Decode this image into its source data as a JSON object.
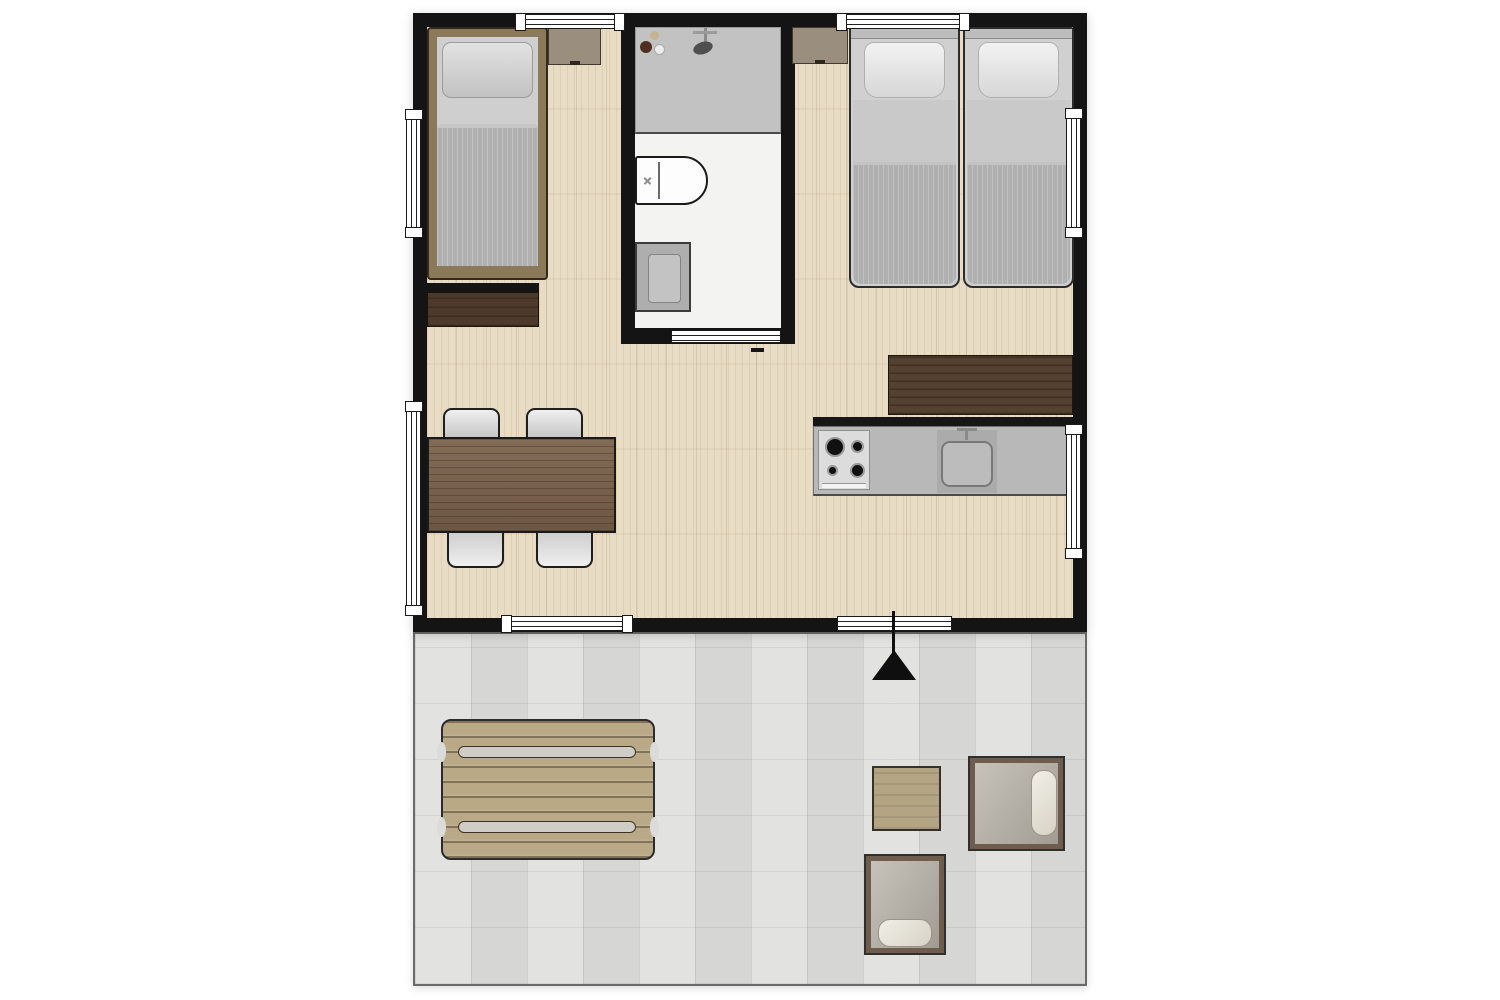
{
  "meta": {
    "type": "floor-plan",
    "view": "top-down",
    "visible_text": "none"
  },
  "palette": {
    "page_bg": "#ffffff",
    "wall": "#141414",
    "wood_floor": "#e9dcc4",
    "bathroom_floor": "#f3f3f1",
    "terrace_floor": "#dbdbd9",
    "window_white": "#ffffff",
    "shower_gray": "#c2c2c2",
    "fixture_white": "#fdfdfd",
    "counter_gray": "#b8b8b8",
    "stove_gray": "#dcdcdc",
    "cabinet_brown": "#54412f",
    "table_brown": "#79614a",
    "bed_frame_tan": "#8c795a",
    "mattress_gray": "#cfcfcf",
    "blanket_gray": "#b0b0b0",
    "pillow_light": "#efefef",
    "nightstand_tan": "#9a8e7e",
    "dresser_brown": "#4d3a2a",
    "chair_gray": "#d8d8d8",
    "picnic_wood": "#b9a987",
    "side_table_wood": "#b3a483",
    "armchair_frame": "#6e5c4d",
    "armchair_seat": "#b5b0a7",
    "cushion_cream": "#ece8dd",
    "arrow_black": "#0f0f0f"
  },
  "plan": {
    "building": {
      "rooms": [
        {
          "name": "bedroom-single",
          "furniture": [
            "single-bed",
            "nightstand",
            "dresser"
          ]
        },
        {
          "name": "bathroom",
          "furniture": [
            "shower",
            "toilet",
            "washbasin"
          ],
          "door": "sliding-door-bottom"
        },
        {
          "name": "bedroom-twin",
          "furniture": [
            "twin-bed-left",
            "twin-bed-right",
            "nightstand"
          ]
        },
        {
          "name": "living-dining",
          "furniture": [
            "dining-table",
            "chair",
            "chair",
            "chair",
            "chair"
          ]
        },
        {
          "name": "kitchenette",
          "furniture": [
            "tall-cabinet",
            "counter",
            "hob-4-burner",
            "kitchen-sink"
          ]
        }
      ],
      "windows": {
        "top_wall": 2,
        "left_wall": 2,
        "right_wall": 2,
        "bottom_wall": 1
      },
      "entrance": "bottom-wall-door-with-up-arrow"
    },
    "terrace": {
      "floor": "tiled",
      "furniture": [
        "picnic-table",
        "side-table",
        "lounge-armchair-facing-left",
        "lounge-armchair-facing-up"
      ],
      "entrance_arrow": "black-triangle-pointing-up"
    }
  }
}
